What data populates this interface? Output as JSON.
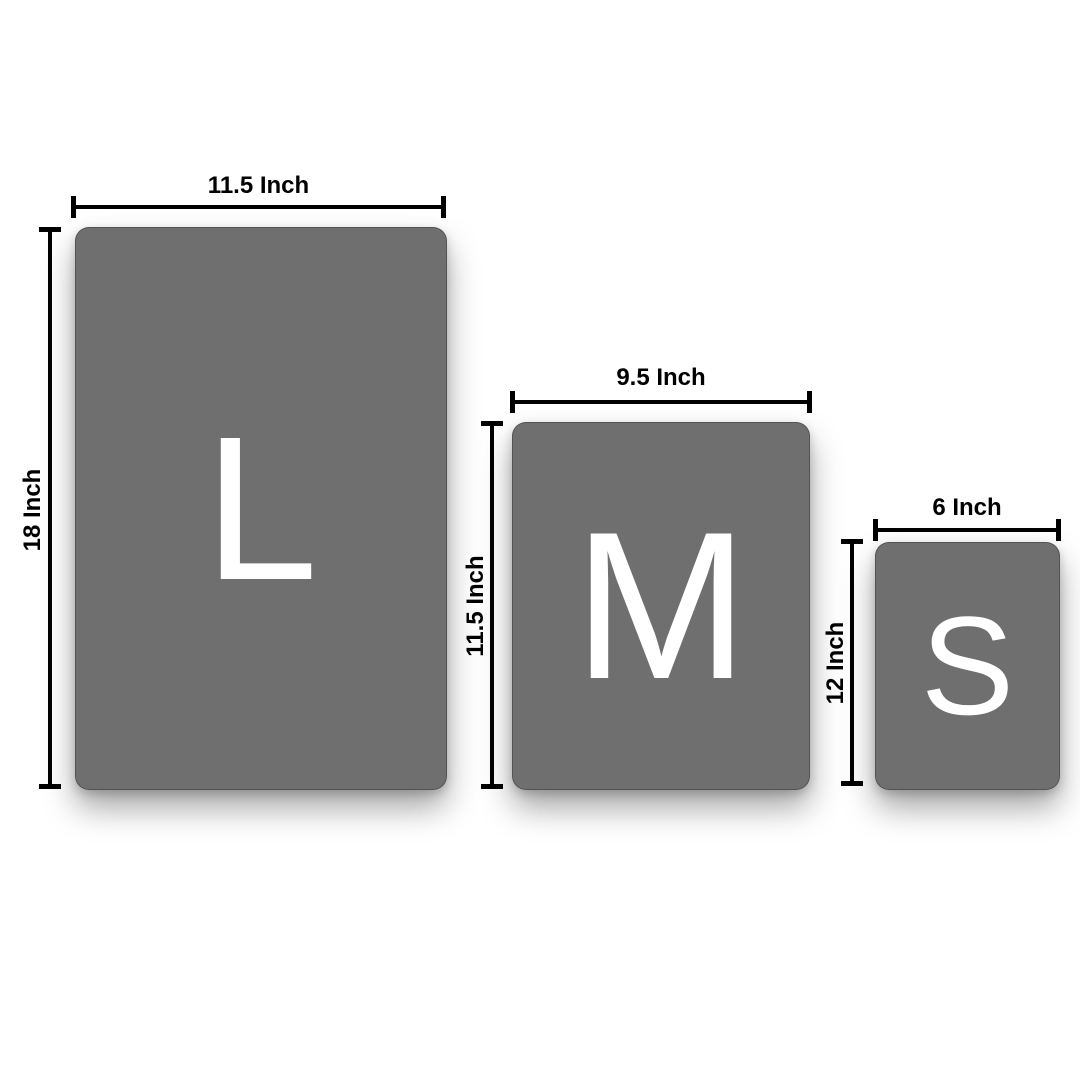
{
  "diagram": {
    "background_color": "#ffffff",
    "card_color": "#6f6f6f",
    "letter_color": "#ffffff",
    "dimension_line_color": "#000000",
    "label_color": "#000000",
    "sizes": [
      {
        "name": "large",
        "letter": "L",
        "width_label": "11.5 Inch",
        "height_label": "18 Inch"
      },
      {
        "name": "medium",
        "letter": "M",
        "width_label": "9.5 Inch",
        "height_label": "11.5 Inch"
      },
      {
        "name": "small",
        "letter": "S",
        "width_label": "6 Inch",
        "height_label": "12 Inch"
      }
    ]
  }
}
